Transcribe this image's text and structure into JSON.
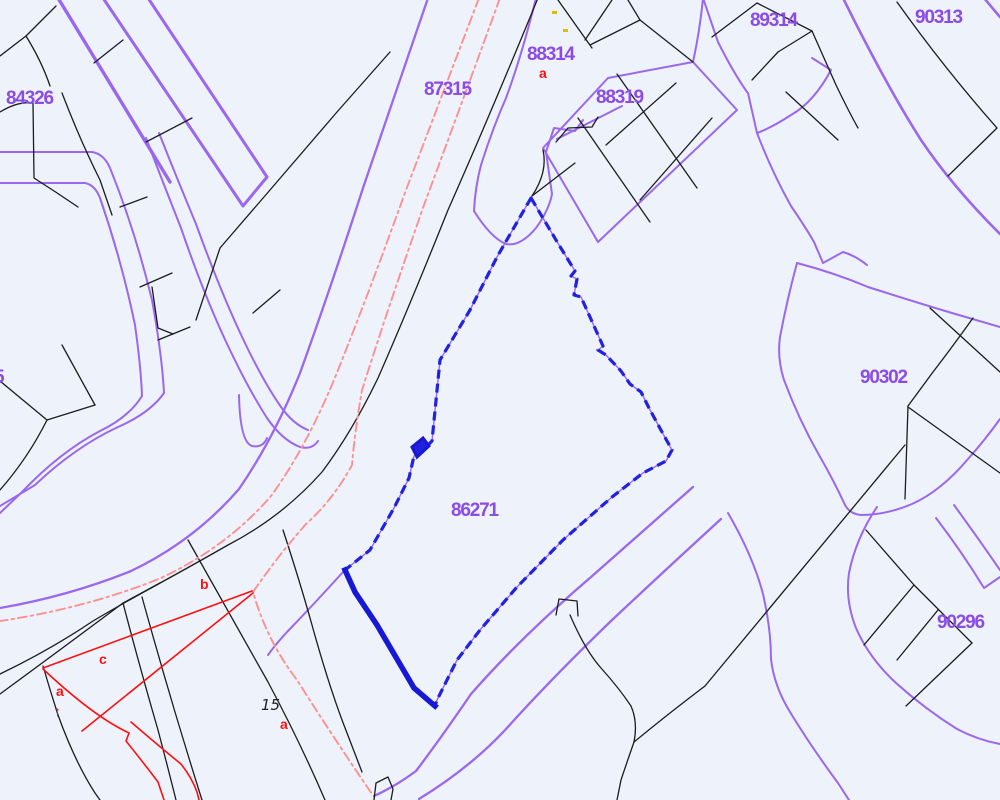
{
  "app": {
    "type": "cadastral-map-view"
  },
  "map": {
    "background_color": "#edf2fb",
    "selected_parcel": {
      "id": "86271",
      "highlight_color": "#2222de"
    },
    "colors": {
      "block_boundary_purple": "#9a68ee",
      "block_label_purple": "#8b4be6",
      "parcel_line_black": "#1c1c1c",
      "annotation_red": "#ff0f0f",
      "survey_dashdot_salmon": "#ff9090",
      "selected_blue": "#2222de",
      "tick_yellow": "#d4c00a"
    },
    "block_labels": [
      {
        "id": "84326",
        "text": "84326"
      },
      {
        "id": "87315",
        "text": "87315"
      },
      {
        "id": "88314",
        "text": "88314"
      },
      {
        "id": "88319",
        "text": "88319"
      },
      {
        "id": "89314",
        "text": "89314"
      },
      {
        "id": "90313",
        "text": "90313"
      },
      {
        "id": "90302",
        "text": "90302"
      },
      {
        "id": "90296",
        "text": "90296"
      },
      {
        "id": "86271",
        "text": "86271"
      },
      {
        "id": "edge-partial",
        "text": "5"
      }
    ],
    "annotation_labels": [
      {
        "id": "a-under-88314",
        "text": "a"
      },
      {
        "id": "b-lower-left",
        "text": "b"
      },
      {
        "id": "c-lower-left",
        "text": "c"
      },
      {
        "id": "a-lower-left",
        "text": "a"
      },
      {
        "id": "arrow-lower-left",
        "text": "↑"
      },
      {
        "id": "house-number",
        "text": "15"
      },
      {
        "id": "a-bottom",
        "text": "a"
      }
    ]
  }
}
